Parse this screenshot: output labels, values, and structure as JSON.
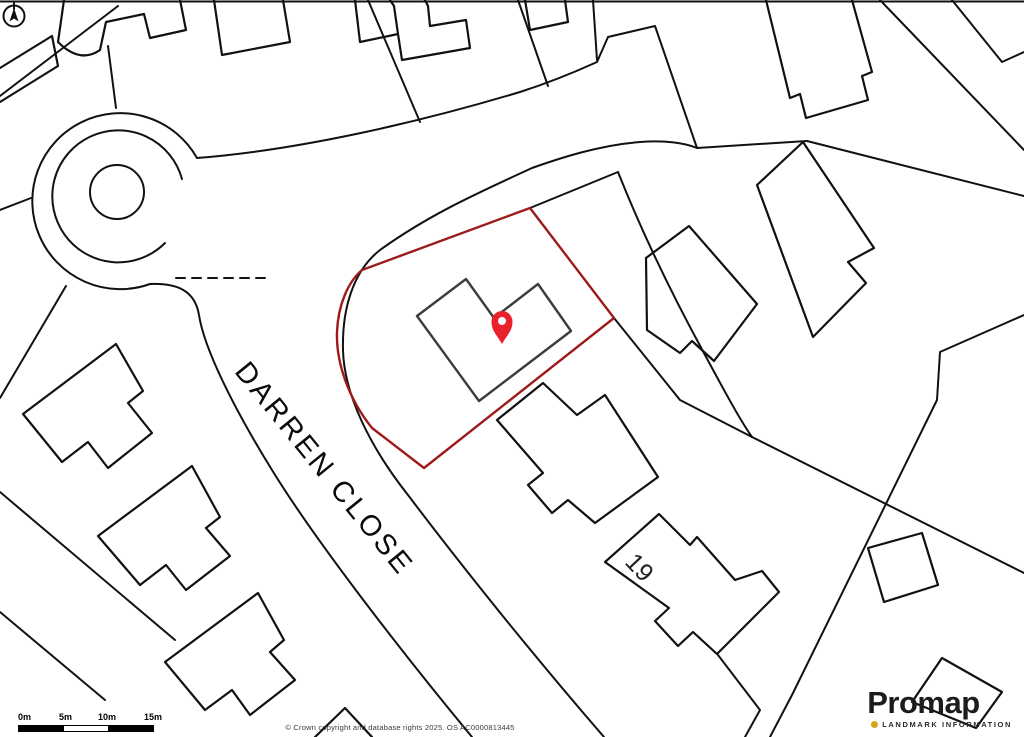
{
  "map": {
    "street_label": "DARREN CLOSE",
    "house_number_label": "19"
  },
  "scale_bar": {
    "labels": [
      "0m",
      "5m",
      "10m",
      "15m"
    ]
  },
  "attribution": "© Crown copyright and database rights 2025. OS AC0000813445",
  "branding": {
    "logo_text": "Promap",
    "tagline": "LANDMARK INFORMATION"
  },
  "colors": {
    "map_lines": "#111111",
    "building_outline": "#3d3d3d",
    "plot_outline": "#9e1b1b",
    "pin": "#e8212a",
    "brand_accent": "#d9a319"
  }
}
